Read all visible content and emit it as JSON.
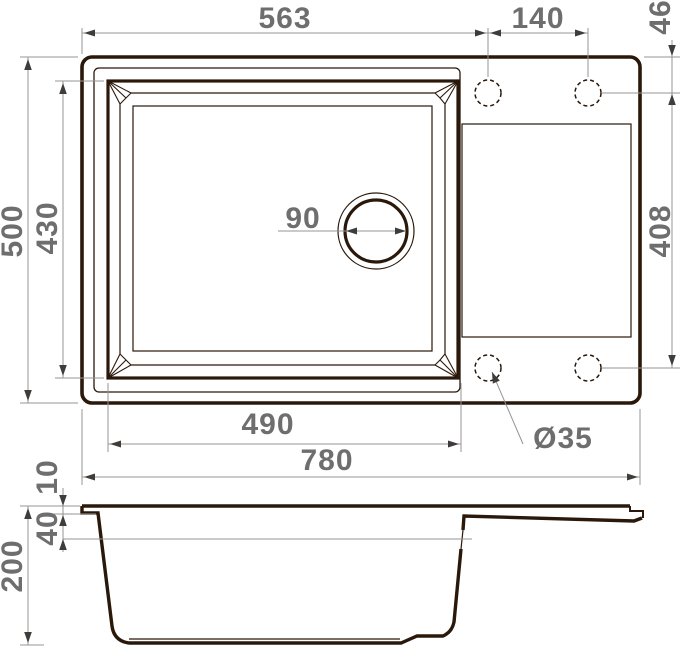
{
  "drawing": {
    "type": "technical-dimension-drawing",
    "subject": "kitchen sink with bowl and drainboard — plan view and section view",
    "units": "mm",
    "colors": {
      "line": "#2a180a",
      "dimension_line": "#949494",
      "text": "#6e6e6e",
      "background": "#ffffff"
    },
    "dims": {
      "overall_width": "780",
      "overall_depth": "500",
      "bowl_width": "490",
      "bowl_depth": "430",
      "edge_to_faucet_hole": "563",
      "faucet_hole_spacing": "140",
      "faucet_hole_top_offset": "46",
      "faucet_hole_span": "408",
      "drain_diameter": "90",
      "faucet_hole_diameter": "Ø35",
      "rim_height": "10",
      "ledge_depth": "40",
      "overall_height": "200"
    }
  }
}
